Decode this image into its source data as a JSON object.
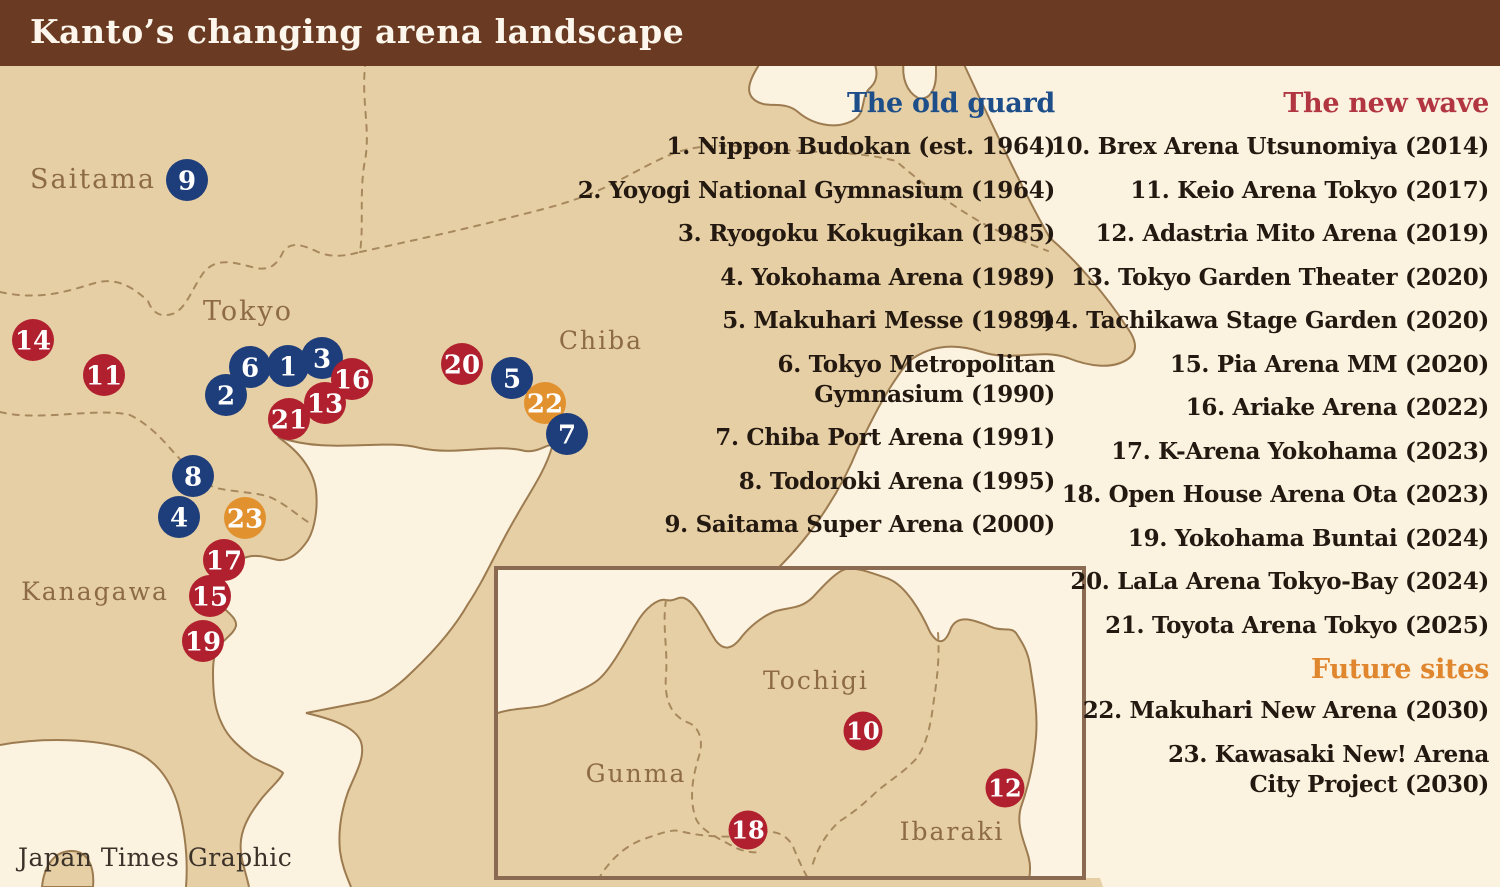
{
  "title": "Kanto’s changing arena landscape",
  "credit": "Japan Times Graphic",
  "colors": {
    "title_bar": "#6a3b22",
    "background": "#fcf2e0",
    "land": "#e6cfa4",
    "coast": "#9c7b50",
    "border_dash": "#a8895e",
    "old_guard": "#1e3d7b",
    "new_wave": "#b1202e",
    "future": "#e2912f",
    "heading_old": "#1d4e89",
    "heading_new": "#b23642",
    "heading_future": "#df862e",
    "list_text": "#241910",
    "map_label": "#8d6b46",
    "marker_number": "#ffffff"
  },
  "legend": {
    "old_guard": {
      "heading": "The old guard",
      "items": [
        "1. Nippon Budokan (est. 1964)",
        "2. Yoyogi National Gymnasium (1964)",
        "3. Ryogoku Kokugikan (1985)",
        "4. Yokohama Arena (1989)",
        "5. Makuhari Messe (1989)",
        "6. Tokyo Metropolitan\nGymnasium (1990)",
        "7. Chiba Port Arena (1991)",
        "8. Todoroki Arena (1995)",
        "9. Saitama Super Arena (2000)"
      ]
    },
    "new_wave": {
      "heading": "The new wave",
      "items": [
        "10. Brex Arena Utsunomiya (2014)",
        "11. Keio Arena Tokyo (2017)",
        "12. Adastria Mito Arena (2019)",
        "13. Tokyo Garden Theater (2020)",
        "14. Tachikawa Stage Garden (2020)",
        "15. Pia Arena MM (2020)",
        "16. Ariake Arena (2022)",
        "17. K-Arena Yokohama (2023)",
        "18. Open House Arena Ota (2023)",
        "19. Yokohama Buntai (2024)",
        "20. LaLa Arena Tokyo-Bay (2024)",
        "21. Toyota Arena Tokyo (2025)"
      ]
    },
    "future_sites": {
      "heading": "Future sites",
      "items": [
        "22. Makuhari New Arena (2030)",
        "23. Kawasaki New! Arena\nCity Project (2030)"
      ]
    }
  },
  "map": {
    "labels": [
      {
        "text": "Saitama",
        "x": 93,
        "y": 188,
        "size": 27
      },
      {
        "text": "Tokyo",
        "x": 248,
        "y": 320,
        "size": 27
      },
      {
        "text": "Chiba",
        "x": 601,
        "y": 349,
        "size": 25
      },
      {
        "text": "Kanagawa",
        "x": 95,
        "y": 600,
        "size": 25
      }
    ],
    "markers": [
      {
        "n": 9,
        "x": 187,
        "y": 180,
        "type": "old_guard"
      },
      {
        "n": 5,
        "x": 512,
        "y": 378,
        "type": "old_guard"
      },
      {
        "n": 8,
        "x": 193,
        "y": 476,
        "type": "old_guard"
      },
      {
        "n": 4,
        "x": 179,
        "y": 517,
        "type": "old_guard"
      },
      {
        "n": 2,
        "x": 226,
        "y": 395,
        "type": "old_guard"
      },
      {
        "n": 6,
        "x": 250,
        "y": 367,
        "type": "old_guard"
      },
      {
        "n": 1,
        "x": 288,
        "y": 366,
        "type": "old_guard"
      },
      {
        "n": 3,
        "x": 322,
        "y": 358,
        "type": "old_guard"
      },
      {
        "n": 20,
        "x": 462,
        "y": 364,
        "type": "new_wave"
      },
      {
        "n": 14,
        "x": 33,
        "y": 340,
        "type": "new_wave"
      },
      {
        "n": 11,
        "x": 104,
        "y": 375,
        "type": "new_wave"
      },
      {
        "n": 16,
        "x": 352,
        "y": 379,
        "type": "new_wave"
      },
      {
        "n": 21,
        "x": 289,
        "y": 419,
        "type": "new_wave"
      },
      {
        "n": 13,
        "x": 325,
        "y": 403,
        "type": "new_wave"
      },
      {
        "n": 17,
        "x": 224,
        "y": 560,
        "type": "new_wave"
      },
      {
        "n": 15,
        "x": 210,
        "y": 596,
        "type": "new_wave"
      },
      {
        "n": 19,
        "x": 203,
        "y": 641,
        "type": "new_wave"
      },
      {
        "n": 22,
        "x": 545,
        "y": 403,
        "type": "future"
      },
      {
        "n": 7,
        "x": 567,
        "y": 434,
        "type": "old_guard"
      },
      {
        "n": 23,
        "x": 245,
        "y": 518,
        "type": "future"
      }
    ]
  },
  "inset": {
    "labels": [
      {
        "text": "Tochigi",
        "x": 816,
        "y": 689,
        "size": 25
      },
      {
        "text": "Gunma",
        "x": 636,
        "y": 782,
        "size": 25
      },
      {
        "text": "Ibaraki",
        "x": 952,
        "y": 840,
        "size": 25
      }
    ],
    "markers": [
      {
        "n": 10,
        "x": 863,
        "y": 731,
        "type": "new_wave"
      },
      {
        "n": 18,
        "x": 748,
        "y": 830,
        "type": "new_wave"
      },
      {
        "n": 12,
        "x": 1005,
        "y": 788,
        "type": "new_wave"
      }
    ]
  }
}
